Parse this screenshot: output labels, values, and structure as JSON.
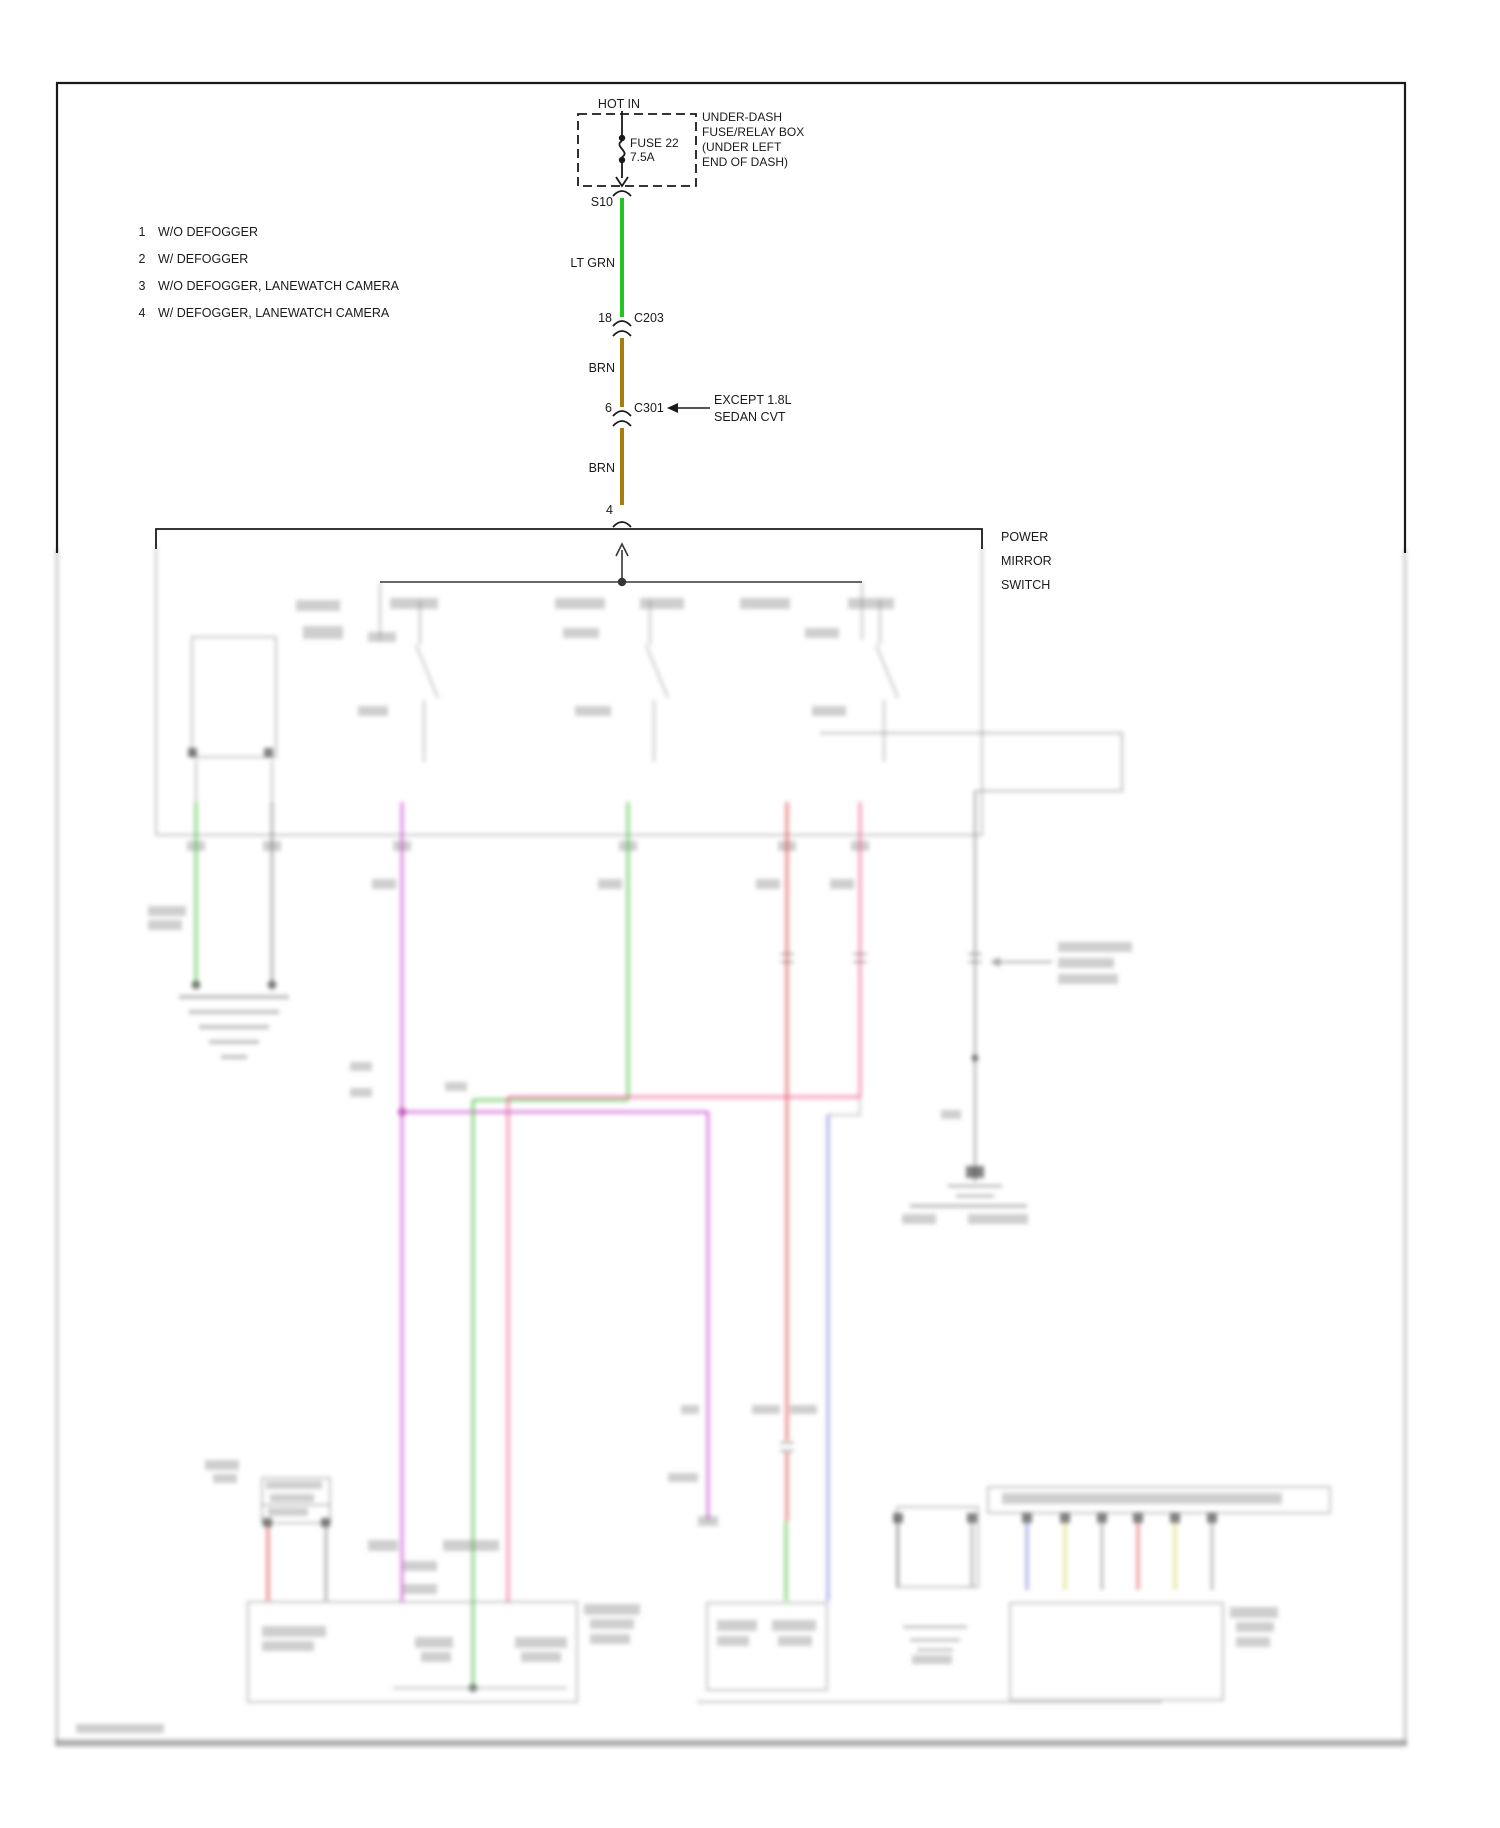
{
  "diagram": {
    "title_note": "wiring diagram, power mirror circuit; lower region faded/blurred preview",
    "hot_in": "HOT IN",
    "fuse": {
      "line1": "FUSE 22",
      "line2": "7.5A"
    },
    "fuse_box_note": {
      "lines": [
        "UNDER-DASH",
        "FUSE/RELAY BOX",
        "(UNDER LEFT",
        "END OF DASH)"
      ]
    },
    "splice": "S10",
    "wire1": {
      "color_label": "LT GRN"
    },
    "c203": {
      "pin": "18",
      "name": "C203"
    },
    "wire2": {
      "color_label": "BRN"
    },
    "c301": {
      "pin": "6",
      "name": "C301",
      "note_line1": "EXCEPT 1.8L",
      "note_line2": "SEDAN CVT"
    },
    "wire3": {
      "color_label": "BRN"
    },
    "switch_pin": "4",
    "switch": {
      "label_lines": [
        "POWER",
        "MIRROR",
        "SWITCH"
      ]
    },
    "legend": [
      {
        "num": "1",
        "text": "W/O DEFOGGER"
      },
      {
        "num": "2",
        "text": "W/ DEFOGGER"
      },
      {
        "num": "3",
        "text": "W/O DEFOGGER, LANEWATCH CAMERA"
      },
      {
        "num": "4",
        "text": "W/ DEFOGGER, LANEWATCH CAMERA"
      }
    ],
    "colors": {
      "lt_grn_wire": "#25c425",
      "brn_wire": "#a87d10",
      "line": "#1a1a1a",
      "faded_magenta": "#cc3fcc",
      "faded_green": "#4bbf3f",
      "faded_red": "#e04540",
      "faded_pink": "#ef5f8f",
      "faded_blue": "#5b5bd6",
      "faded_yellow": "#d9d960",
      "faded_gray": "#8a8a8a"
    }
  }
}
